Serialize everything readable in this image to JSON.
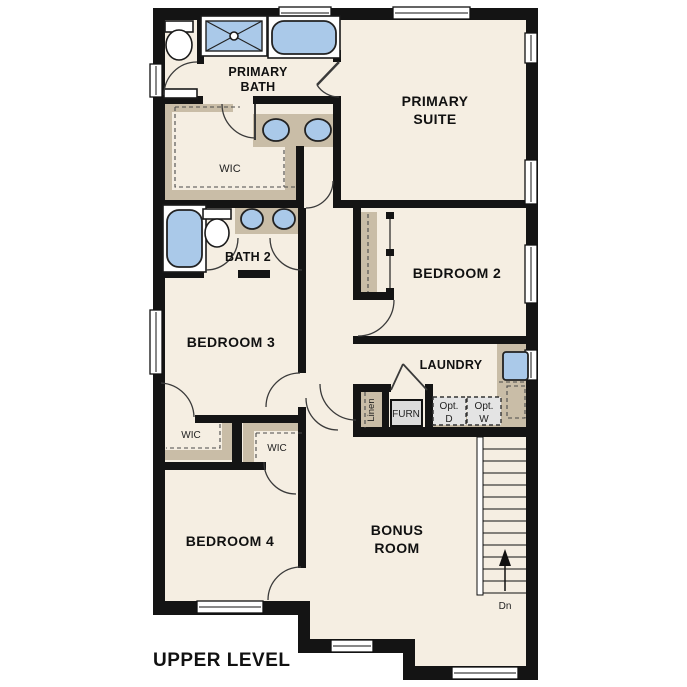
{
  "title": "UPPER LEVEL",
  "colors": {
    "wall": "#141414",
    "floor": "#f5eee2",
    "casework": "#c9bda7",
    "fixture_blue": "#aac9e9",
    "opt_fill": "#e4e4e4",
    "label": "#111111"
  },
  "rooms": {
    "primary_bath": {
      "line1": "PRIMARY",
      "line2": "BATH"
    },
    "primary_suite": {
      "line1": "PRIMARY",
      "line2": "SUITE"
    },
    "wic_primary": "WIC",
    "bath2": "BATH 2",
    "bedroom2": "BEDROOM 2",
    "bedroom3": "BEDROOM 3",
    "laundry": "LAUNDRY",
    "wic_bedroom3": "WIC",
    "wic_bedroom4": "WIC",
    "bedroom4": "BEDROOM 4",
    "bonus_room": {
      "line1": "BONUS",
      "line2": "ROOM"
    }
  },
  "fixtures": {
    "linen_closet": "Linen",
    "furnace": "FURN",
    "opt_dryer": {
      "line1": "Opt.",
      "line2": "D"
    },
    "opt_washer": {
      "line1": "Opt.",
      "line2": "W"
    },
    "stairs_direction": "Dn"
  }
}
